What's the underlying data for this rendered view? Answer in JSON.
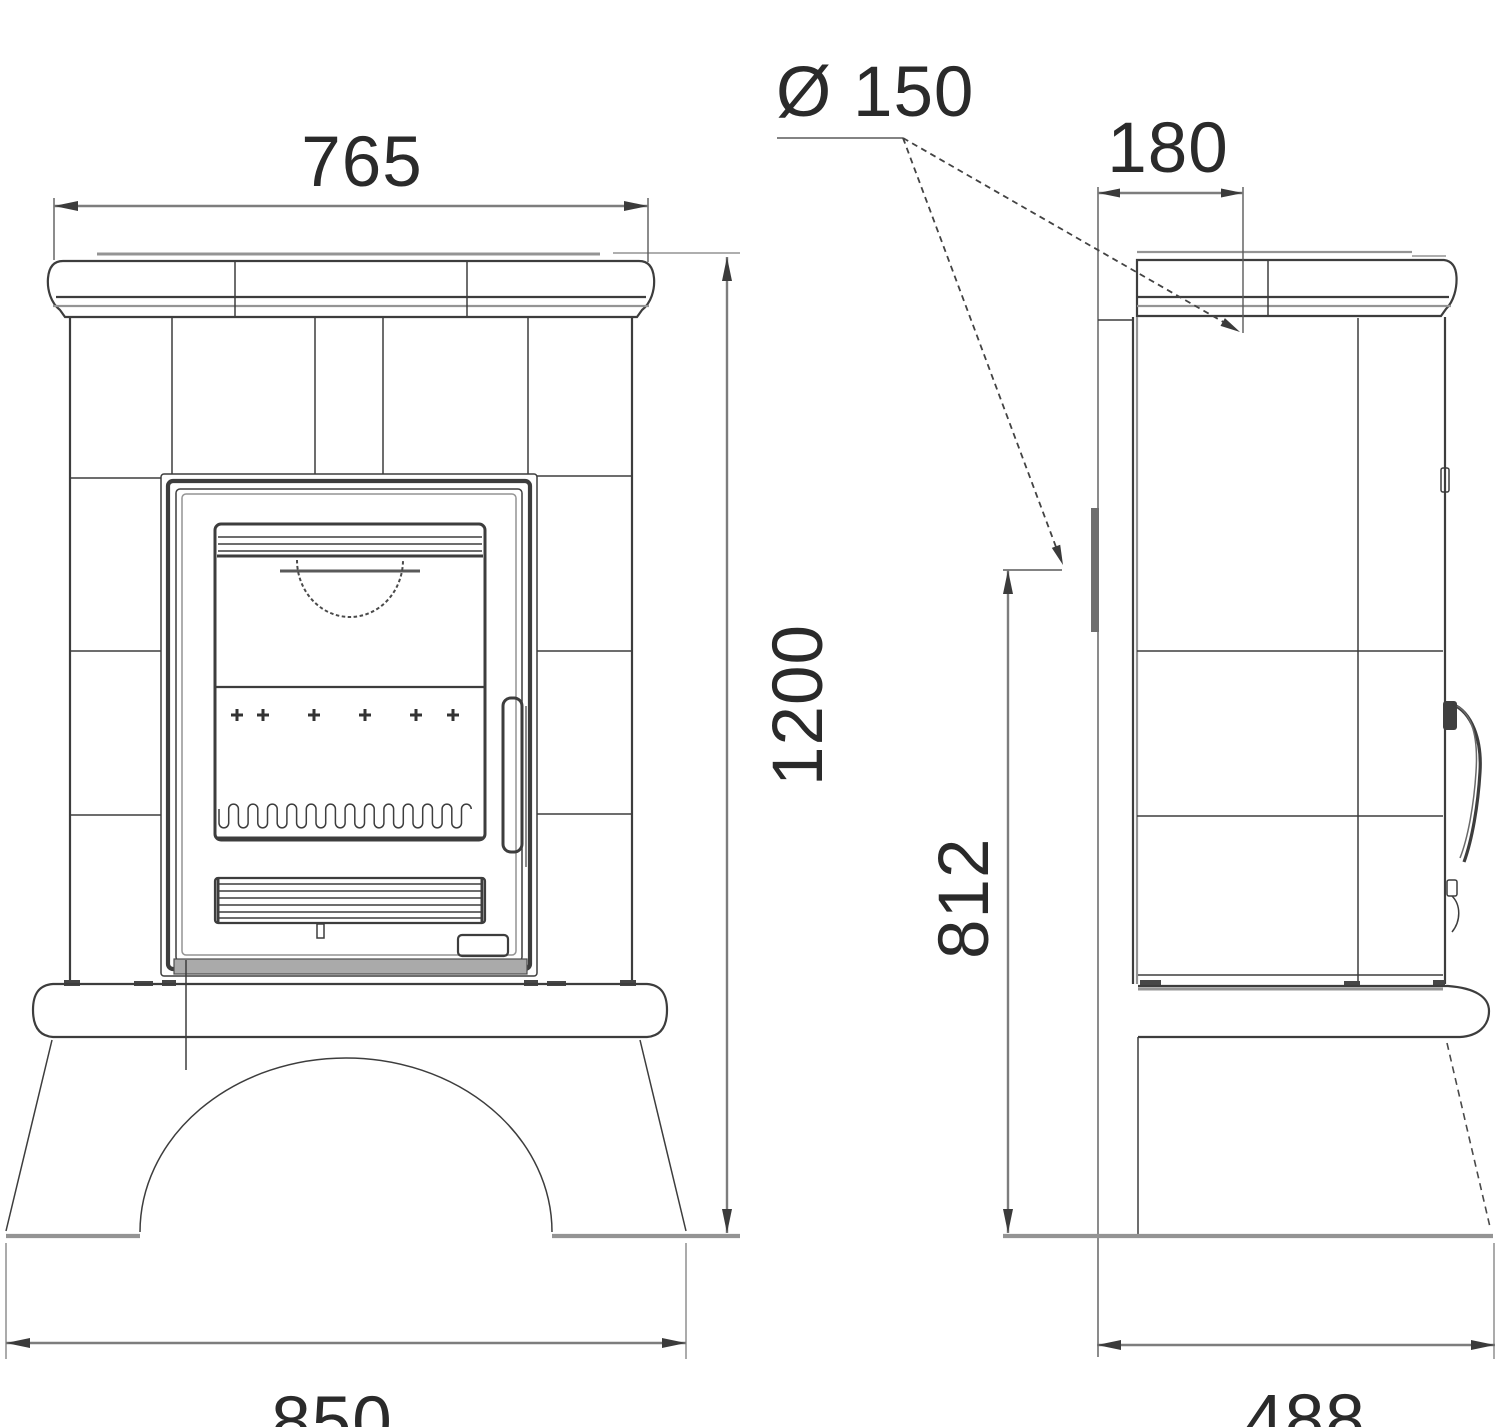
{
  "drawing": {
    "title": "Tiled wood-burning stove dimensional drawing (front and side views)",
    "units": "mm",
    "colors": {
      "line": "#3d3d3d",
      "gray_line": "#949494",
      "dim_line": "#7d7d7d",
      "text": "#2a2a2a",
      "background": "#ffffff"
    }
  },
  "dimensions": {
    "top_width": {
      "value": "765"
    },
    "flue_diameter": {
      "value": "Ø 150"
    },
    "top_depth": {
      "value": "180"
    },
    "total_height": {
      "value": "1200"
    },
    "flue_height": {
      "value": "812"
    },
    "base_width": {
      "value": "850"
    },
    "base_depth": {
      "value": "488"
    }
  }
}
